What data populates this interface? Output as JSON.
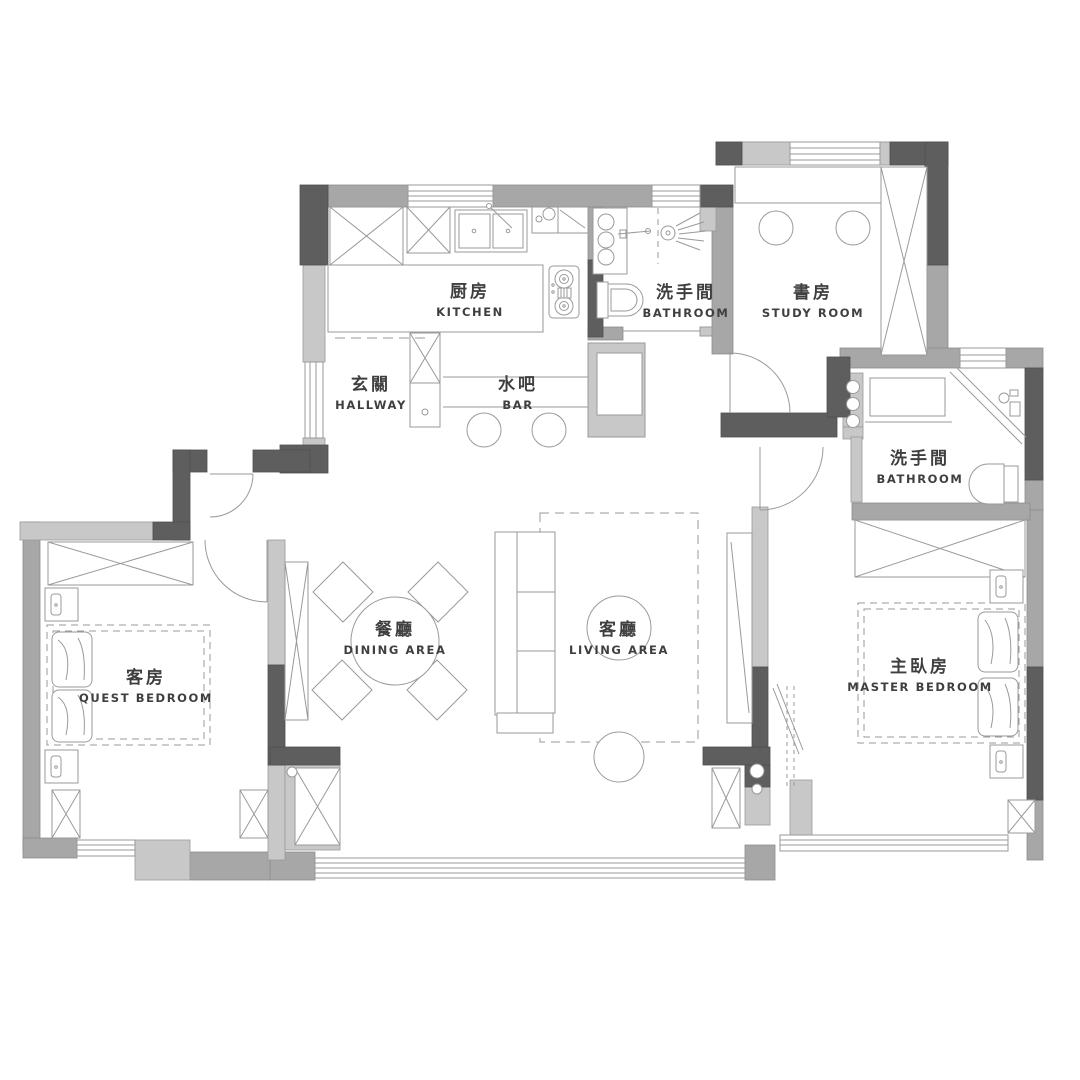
{
  "plan": {
    "type": "apartment-floor-plan",
    "background": "#ffffff",
    "colors": {
      "wall_dark": "#5e5e5e",
      "wall_medium": "#a7a7a7",
      "wall_light": "#c8c8c8",
      "furniture_line": "#939393",
      "label_text": "#3f3f3f"
    },
    "rooms": [
      {
        "id": "kitchen",
        "zh": "厨房",
        "en": "KITCHEN"
      },
      {
        "id": "bathroom-top",
        "zh": "洗手間",
        "en": "BATHROOM"
      },
      {
        "id": "study-room",
        "zh": "書房",
        "en": "STUDY ROOM"
      },
      {
        "id": "hallway",
        "zh": "玄關",
        "en": "HALLWAY"
      },
      {
        "id": "bar",
        "zh": "水吧",
        "en": "BAR"
      },
      {
        "id": "bathroom-right",
        "zh": "洗手間",
        "en": "BATHROOM"
      },
      {
        "id": "guest-bedroom",
        "zh": "客房",
        "en": "QUEST BEDROOM"
      },
      {
        "id": "dining-area",
        "zh": "餐廳",
        "en": "DINING AREA"
      },
      {
        "id": "living-area",
        "zh": "客廳",
        "en": "LIVING AREA"
      },
      {
        "id": "master-bedroom",
        "zh": "主臥房",
        "en": "MASTER BEDROOM"
      }
    ]
  }
}
